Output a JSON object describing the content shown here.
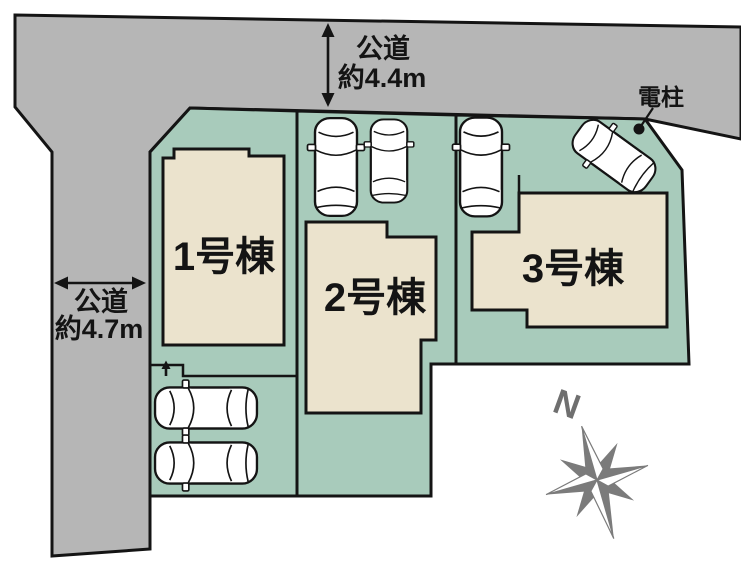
{
  "colors": {
    "background": "#ffffff",
    "road_gray": "#b6b6b6",
    "plot_green": "#a8cbbb",
    "house_beige": "#ebe3cd",
    "outline_black": "#141414",
    "compass_gray": "#7b7b7b"
  },
  "roads": {
    "top": {
      "name": "公道",
      "width_label": "約4.4m"
    },
    "left": {
      "name": "公道",
      "width_label": "約4.7m"
    }
  },
  "pole": {
    "label": "電柱"
  },
  "buildings": [
    {
      "label": "1号棟"
    },
    {
      "label": "2号棟"
    },
    {
      "label": "3号棟"
    }
  ],
  "compass": {
    "north_label": "N"
  },
  "cars": {
    "count": 6
  }
}
